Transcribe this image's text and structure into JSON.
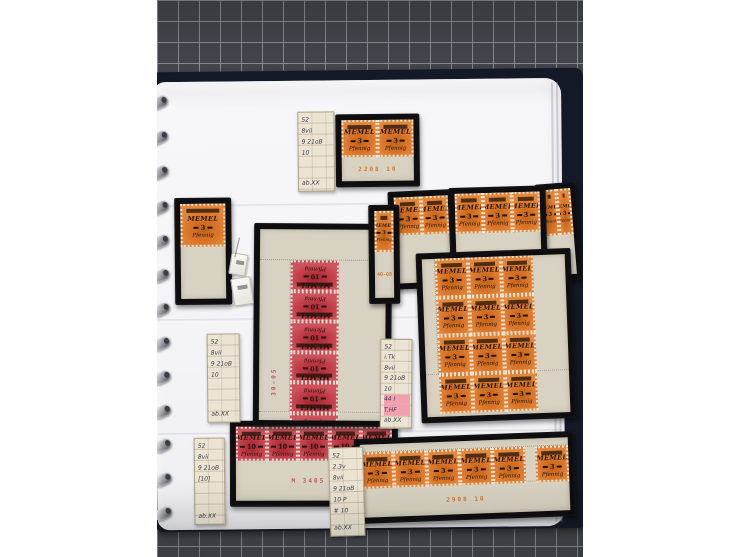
{
  "colors": {
    "checker_bg": "#45484e",
    "checker_line": "#969aa0",
    "album_cover": "#141927",
    "page": "#f5f5f7",
    "mount_black": "#0e0e10",
    "sheet_beige": "#d8d2c2",
    "label_cream": "#ebe4d2",
    "stamp_orange": "#d97428",
    "stamp_red": "#bf3a45",
    "overprint": "#20130a",
    "orange_margin_text": "#cf7a2e",
    "red_margin_text": "#c5535c",
    "highlight_pink": "#f2a0af"
  },
  "stamp_types": {
    "orange": {
      "country": "MEMEL",
      "value": "3",
      "currency": "Pfennig"
    },
    "red": {
      "country": "MEMEL",
      "value": "10",
      "currency": "Pfennig"
    }
  },
  "scene": {
    "ring_ys": [
      95,
      130,
      165,
      200,
      234,
      268,
      302,
      336,
      370,
      404,
      438,
      472,
      506
    ],
    "seam_ys": [
      203,
      317,
      431
    ],
    "stack_xs": [
      396,
      401
    ]
  },
  "mounts": [
    {
      "id": "pair-top",
      "x": 180,
      "y": 114,
      "w": 84,
      "h": 73,
      "rot": 0,
      "z": 12,
      "kind": "orange",
      "cols": 2,
      "rows": 1,
      "bottomM": 24,
      "bottomText": "2208  10"
    },
    {
      "id": "single-left",
      "x": 18,
      "y": 196,
      "w": 57,
      "h": 107,
      "rot": 0,
      "z": 12,
      "kind": "orange",
      "cols": 1,
      "rows": 1,
      "bottomM": 52,
      "bottomText": ""
    },
    {
      "id": "red-block-10",
      "x": 96,
      "y": 223,
      "w": 138,
      "h": 203,
      "rot": 1,
      "z": 14,
      "kind": "red",
      "cols": 2,
      "rows": 5,
      "leftM": 30,
      "topM": 30,
      "bottomM": 8,
      "vertText": "30-05",
      "inverted": true
    },
    {
      "id": "narrow-single",
      "x": 212,
      "y": 205,
      "w": 31,
      "h": 99,
      "rot": 0,
      "z": 16,
      "kind": "orange",
      "cols": 1,
      "rows": 1,
      "bottomM": 46,
      "bottomText": "40-08",
      "smallText": true
    },
    {
      "id": "corner-pair-tr",
      "x": 233,
      "y": 191,
      "w": 66,
      "h": 98,
      "rot": -2,
      "z": 11,
      "kind": "orange",
      "cols": 2,
      "rows": 1,
      "bottomM": 48,
      "bottomText": ""
    },
    {
      "id": "strip3-tr",
      "x": 293,
      "y": 188,
      "w": 97,
      "h": 74,
      "rot": -1,
      "z": 11,
      "kind": "orange",
      "cols": 3,
      "rows": 1,
      "bottomM": 22,
      "bottomText": ""
    },
    {
      "id": "pair-right-edge",
      "x": 382,
      "y": 185,
      "w": 41,
      "h": 98,
      "rot": -4,
      "z": 10,
      "kind": "orange",
      "cols": 2,
      "rows": 1,
      "bottomM": 40,
      "bottomText": ""
    },
    {
      "id": "block12-orange",
      "x": 261,
      "y": 252,
      "w": 155,
      "h": 170,
      "rot": -1.5,
      "z": 14,
      "kind": "orange",
      "cols": 4,
      "rows": 3,
      "leftM": 12,
      "bottomM": 42,
      "bottomText": "28-8  10"
    },
    {
      "id": "strip5-red",
      "x": 71,
      "y": 420,
      "w": 168,
      "h": 86,
      "rot": 0.5,
      "z": 12,
      "kind": "red",
      "cols": 5,
      "rows": 1,
      "bottomM": 40,
      "bottomText": "M  3405  4"
    },
    {
      "id": "strip6-bottom",
      "x": 196,
      "y": 436,
      "w": 220,
      "h": 85,
      "rot": -1.5,
      "z": 16,
      "kind": "orange",
      "cols": 6,
      "rows": 1,
      "topM": 7,
      "bottomM": 30,
      "bottomText": "2908  10",
      "gutterBefore": 5
    }
  ],
  "labels": [
    {
      "id": "note-top",
      "x": 142,
      "y": 111,
      "w": 37,
      "h": 80,
      "rot": 0,
      "z": 13,
      "lines": [
        "52",
        "8vii",
        "9 21oB",
        "10",
        "ab.XX"
      ],
      "highlight": []
    },
    {
      "id": "note-mid-left",
      "x": 49,
      "y": 332,
      "w": 33,
      "h": 89,
      "rot": 0,
      "z": 13,
      "lines": [
        "52",
        "8vii",
        "9 21oB",
        "10",
        "ab.XX"
      ],
      "highlight": []
    },
    {
      "id": "note-mid-right",
      "x": 222,
      "y": 339,
      "w": 32,
      "h": 90,
      "rot": 1,
      "z": 18,
      "lines": [
        "52",
        "i.Tk",
        "8vii",
        "9 21oB",
        "10",
        "44 I",
        "T.HF",
        "ab.XX"
      ],
      "highlight": [
        5,
        6
      ]
    },
    {
      "id": "note-bottom-left",
      "x": 35,
      "y": 436,
      "w": 31,
      "h": 87,
      "rot": 0,
      "z": 13,
      "lines": [
        "52",
        "8vii",
        "9 21oB",
        "[10]",
        "ab.XX"
      ],
      "highlight": []
    },
    {
      "id": "note-bottom-mid",
      "x": 170,
      "y": 447,
      "w": 35,
      "h": 89,
      "rot": -1,
      "z": 18,
      "lines": [
        "52",
        "2.3v",
        "8vii",
        "9 21oB",
        "10 P",
        "# 10",
        "ab.XX"
      ],
      "highlight": []
    }
  ],
  "tags": [
    {
      "id": "tag-small",
      "x": 73,
      "y": 252,
      "w": 15,
      "h": 20,
      "rot": 10
    },
    {
      "id": "tag-large",
      "x": 75,
      "y": 276,
      "w": 18,
      "h": 26,
      "rot": -8
    }
  ]
}
